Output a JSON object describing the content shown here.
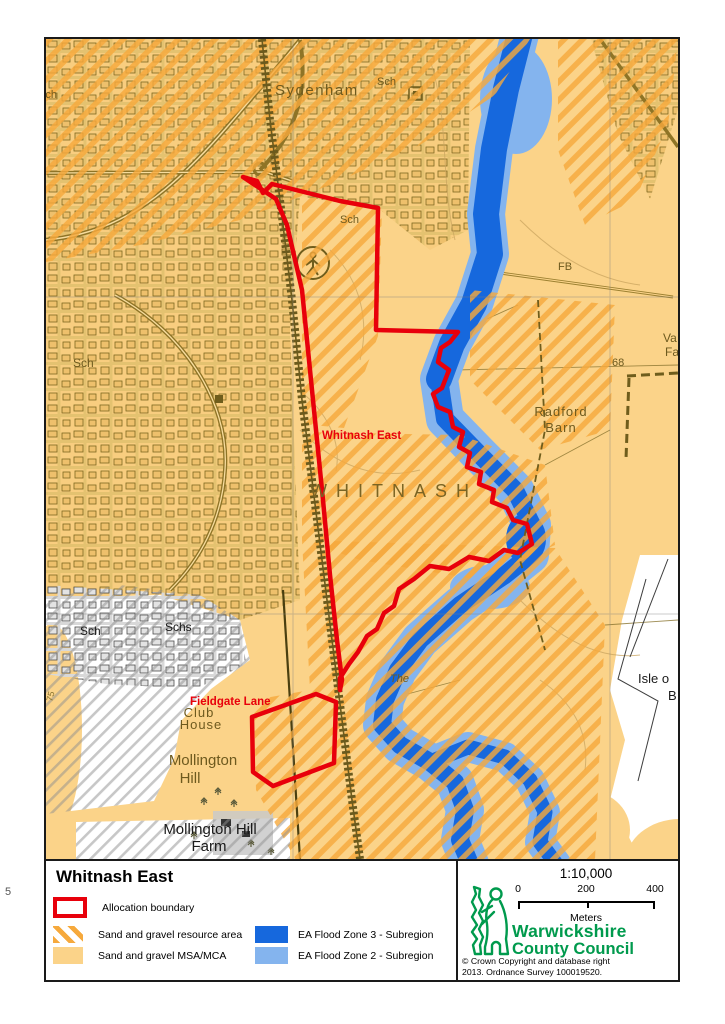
{
  "page": {
    "margin_note": "5"
  },
  "map": {
    "labels": {
      "sydenham": "Sydenham",
      "sch_top": "Sch",
      "sch_site": "Sch",
      "sch_nw": "Sch",
      "sch_w": "Sch",
      "sch_sw": "Sch",
      "schs": "Schs",
      "whitnash": "WHITNASH",
      "radford_line1": "Radford",
      "radford_line2": "Barn",
      "fb": "FB",
      "spot_height": "68",
      "va": "Va",
      "fa": "Fa",
      "the": "The",
      "club": "Club",
      "house": "House",
      "mollington_line1": "Mollington",
      "mollington_line2": "Hill",
      "farm_line1": "Mollington Hill",
      "farm_line2": "Farm",
      "isle_line1": "Isle o",
      "isle_line2": "B",
      "road_ref": "75"
    },
    "annotations": {
      "site_label": "Whitnash East",
      "parcel_label": "Fieldgate Lane"
    }
  },
  "legend": {
    "title": "Whitnash East",
    "items": [
      {
        "label": "Allocation boundary",
        "swatch": "red-outline"
      },
      {
        "label": "Sand and gravel resource area",
        "swatch": "orange-hatch"
      },
      {
        "label": "Sand and gravel MSA/MCA",
        "swatch": "orange-solid"
      },
      {
        "label": "EA Flood Zone 3 - Subregion",
        "swatch": "blue-dark"
      },
      {
        "label": "EA Flood Zone 2 - Subregion",
        "swatch": "blue-light"
      }
    ]
  },
  "scalebar": {
    "ratio": "1:10,000",
    "ticks": [
      "0",
      "200",
      "400"
    ],
    "unit": "Meters"
  },
  "credits": {
    "council_line1": "Warwickshire",
    "council_line2": "County Council",
    "copyright_line1": "© Crown Copyright and database right",
    "copyright_line2": "2013. Ordnance Survey 100019520."
  },
  "colors": {
    "msa_orange": "#fbd389",
    "resource_hatch_orange": "#f6a93c",
    "flood_zone3_blue": "#1668dd",
    "flood_zone2_blue": "#84b4ee",
    "boundary_red": "#e8000b",
    "council_green": "#009a4d"
  }
}
